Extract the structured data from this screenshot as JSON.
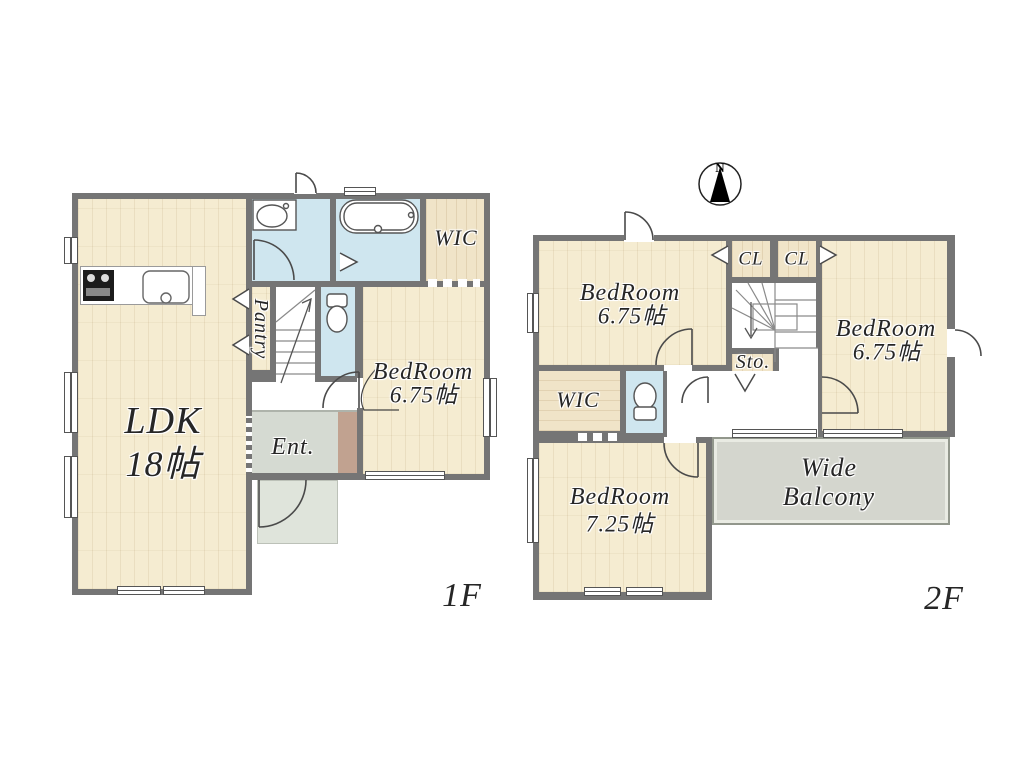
{
  "floor1": {
    "floor_label": "1F",
    "ldk": {
      "line1": "LDK",
      "line2": "18帖"
    },
    "bedroom": {
      "line1": "BedRoom",
      "line2": "6.75帖"
    },
    "pantry": "Pantry",
    "wic": "WIC",
    "entrance": "Ent."
  },
  "floor2": {
    "floor_label": "2F",
    "bedroom_top_left": {
      "line1": "BedRoom",
      "line2": "6.75帖"
    },
    "bedroom_right": {
      "line1": "BedRoom",
      "line2": "6.75帖"
    },
    "bedroom_bottom_left": {
      "line1": "BedRoom",
      "line2": "7.25帖"
    },
    "wic": "WIC",
    "closet_left": "CL",
    "closet_right": "CL",
    "storage": "Sto.",
    "balcony": {
      "line1": "Wide",
      "line2": "Balcony"
    }
  },
  "compass": {
    "north": "N"
  },
  "colors": {
    "wall": "#757575",
    "wood_floor": "#f5ecd1",
    "wet_room": "#cfe6ef",
    "entrance_tile": "#d5dad2",
    "porch": "#dfe4db",
    "step_strip": "#c1a290",
    "balcony": "#d4d6ce",
    "label_text": "#262626"
  }
}
